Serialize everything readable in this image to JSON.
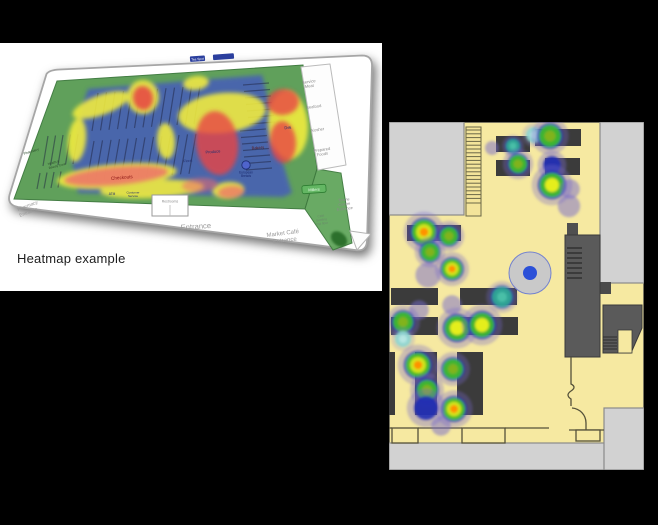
{
  "scene": {
    "background": "#000000"
  },
  "left_figure": {
    "caption": "Heatmap example",
    "labels": {
      "tea_spot": "Tea Spot",
      "pharmacy_entrance": [
        "Pharmacy",
        "Entrance"
      ],
      "entrance": "Entrance",
      "market_cafe_entrance": [
        "Market Café",
        "Entrance"
      ],
      "towne_centre_entrance": [
        "Towne",
        "Centre",
        "Entrance"
      ],
      "cafe_seating": [
        "Café",
        "Seating",
        "2nd floor"
      ],
      "service_meat": [
        "Service",
        "Meat"
      ],
      "seafood": "Seafood",
      "kosher": "Kosher",
      "prepared_foods": [
        "Prepared",
        "Foods"
      ],
      "checkouts": "Checkouts",
      "produce": "Produce",
      "floral": "Floral",
      "bakery": "Bakery",
      "deli": "Deli",
      "pharmacy": "Pharmacy",
      "health_beauty": [
        "Health &",
        "Beauty Care"
      ],
      "atm": "ATM",
      "customer_service": [
        "Customer",
        "Service"
      ],
      "restrooms": "Restrooms",
      "european_breads": [
        "European",
        "Breads"
      ],
      "millers_badge": "Millers"
    },
    "heat_colors": {
      "cold_green": "#63a75e",
      "cool_blue": "#4352c8",
      "warm_yellow": "#f4ee3e",
      "hot_red": "#e84343",
      "checkout_salmon": "#ef6b6b"
    }
  },
  "right_figure": {
    "floor_color": "#f6e9a1",
    "zone_gray": "#d2d2d2",
    "desk_color": "#3b3b3b",
    "structure_gray": "#5a5a5a",
    "column": {
      "cx": 141,
      "cy": 151,
      "r": 21,
      "dot_r": 7,
      "dot_color": "#2b50d8",
      "fill": "#c9c9c9",
      "ring": "#7382cf"
    },
    "desks": [
      [
        107,
        14,
        34,
        16
      ],
      [
        146,
        7,
        46,
        17
      ],
      [
        107,
        38,
        34,
        16
      ],
      [
        156,
        36,
        35,
        17
      ],
      [
        18,
        103,
        54,
        16
      ],
      [
        2,
        166,
        47,
        17
      ],
      [
        71,
        166,
        57,
        17
      ],
      [
        2,
        195,
        47,
        18
      ],
      [
        71,
        195,
        58,
        18
      ],
      [
        0,
        230,
        6,
        63
      ],
      [
        26,
        230,
        22,
        63
      ],
      [
        68,
        230,
        26,
        63
      ]
    ],
    "heat_palette": {
      "green": [
        [
          1.7,
          "#7668cc",
          0.33
        ],
        [
          1.2,
          "#1e2db5",
          0.72
        ],
        [
          1.0,
          "#3dbb2a",
          0.95
        ],
        [
          0.5,
          "#8ab31e",
          0.9
        ]
      ],
      "warm": [
        [
          1.7,
          "#7668cc",
          0.33
        ],
        [
          1.2,
          "#1e2db5",
          0.72
        ],
        [
          1.0,
          "#3dbb2a",
          0.95
        ],
        [
          0.58,
          "#eef11c",
          0.95
        ]
      ],
      "hot": [
        [
          1.7,
          "#7668cc",
          0.33
        ],
        [
          1.2,
          "#1e2db5",
          0.72
        ],
        [
          1.0,
          "#49c21f",
          0.95
        ],
        [
          0.66,
          "#d8e81e",
          0.95
        ],
        [
          0.36,
          "#ff9100",
          1.0
        ]
      ],
      "teal": [
        [
          1.6,
          "#7668cc",
          0.28
        ],
        [
          1.2,
          "#2740c0",
          0.6
        ],
        [
          1.0,
          "#2ea893",
          0.95
        ],
        [
          0.5,
          "#4cc2aa",
          0.9
        ]
      ],
      "cyan": [
        [
          1.5,
          "#8a7fd0",
          0.25
        ],
        [
          1.0,
          "#8fd6d2",
          0.95
        ],
        [
          0.5,
          "#bde9e6",
          0.9
        ]
      ],
      "blue": [
        [
          1.6,
          "#7668cc",
          0.38
        ],
        [
          1.0,
          "#1e2db5",
          0.9
        ]
      ],
      "purple": [
        [
          1.4,
          "#7668cc",
          0.5
        ]
      ]
    },
    "heat_points": [
      {
        "x": 124,
        "y": 24,
        "r": 7,
        "t": "teal"
      },
      {
        "x": 145,
        "y": 13,
        "r": 8,
        "t": "cyan"
      },
      {
        "x": 161,
        "y": 14,
        "r": 11,
        "t": "green"
      },
      {
        "x": 103,
        "y": 26,
        "r": 5,
        "t": "purple"
      },
      {
        "x": 129,
        "y": 42,
        "r": 9,
        "t": "green"
      },
      {
        "x": 163,
        "y": 43,
        "r": 9,
        "t": "blue"
      },
      {
        "x": 163,
        "y": 63,
        "r": 12,
        "t": "warm"
      },
      {
        "x": 181,
        "y": 67,
        "r": 7,
        "t": "purple"
      },
      {
        "x": 180,
        "y": 84,
        "r": 8,
        "t": "purple"
      },
      {
        "x": 35,
        "y": 110,
        "r": 12,
        "t": "hot"
      },
      {
        "x": 60,
        "y": 114,
        "r": 9,
        "t": "green"
      },
      {
        "x": 41,
        "y": 130,
        "r": 9,
        "t": "green"
      },
      {
        "x": 39,
        "y": 153,
        "r": 9,
        "t": "purple"
      },
      {
        "x": 63,
        "y": 147,
        "r": 10,
        "t": "hot"
      },
      {
        "x": 113,
        "y": 175,
        "r": 10,
        "t": "teal"
      },
      {
        "x": 30,
        "y": 188,
        "r": 7,
        "t": "purple"
      },
      {
        "x": 63,
        "y": 183,
        "r": 7,
        "t": "purple"
      },
      {
        "x": 14,
        "y": 200,
        "r": 10,
        "t": "green"
      },
      {
        "x": 14,
        "y": 217,
        "r": 8,
        "t": "cyan"
      },
      {
        "x": 68,
        "y": 206,
        "r": 12,
        "t": "warm"
      },
      {
        "x": 93,
        "y": 203,
        "r": 12,
        "t": "warm"
      },
      {
        "x": 29,
        "y": 243,
        "r": 12,
        "t": "hot"
      },
      {
        "x": 64,
        "y": 247,
        "r": 10,
        "t": "green"
      },
      {
        "x": 38,
        "y": 268,
        "r": 10,
        "t": "green"
      },
      {
        "x": 65,
        "y": 287,
        "r": 11,
        "t": "hot"
      },
      {
        "x": 37,
        "y": 286,
        "r": 12,
        "t": "blue"
      },
      {
        "x": 52,
        "y": 304,
        "r": 7,
        "t": "purple"
      }
    ]
  }
}
